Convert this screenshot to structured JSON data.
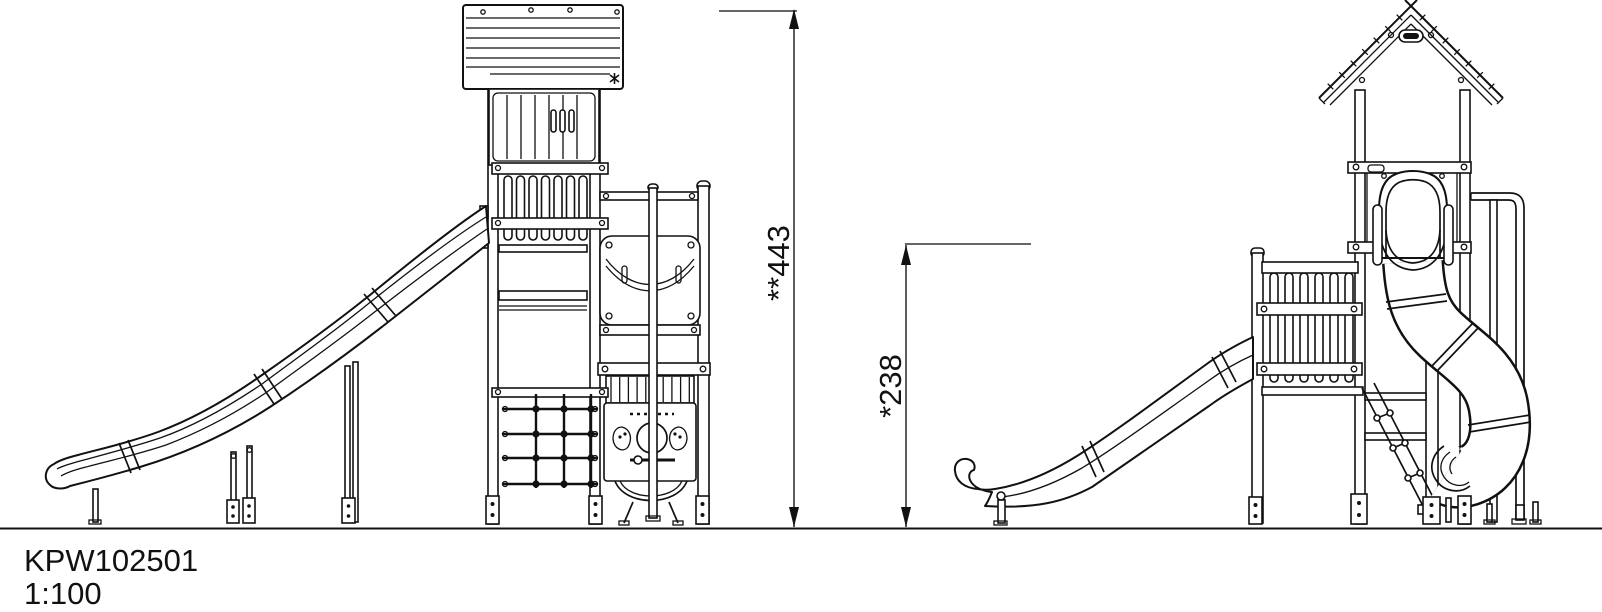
{
  "title_block": {
    "drawing_number": "KPW102501",
    "scale": "1:100"
  },
  "dimensions": {
    "overall_height": {
      "label": "**443"
    },
    "platform_height": {
      "label": "*238"
    }
  },
  "colors": {
    "ink": "#111111",
    "background": "#ffffff"
  }
}
